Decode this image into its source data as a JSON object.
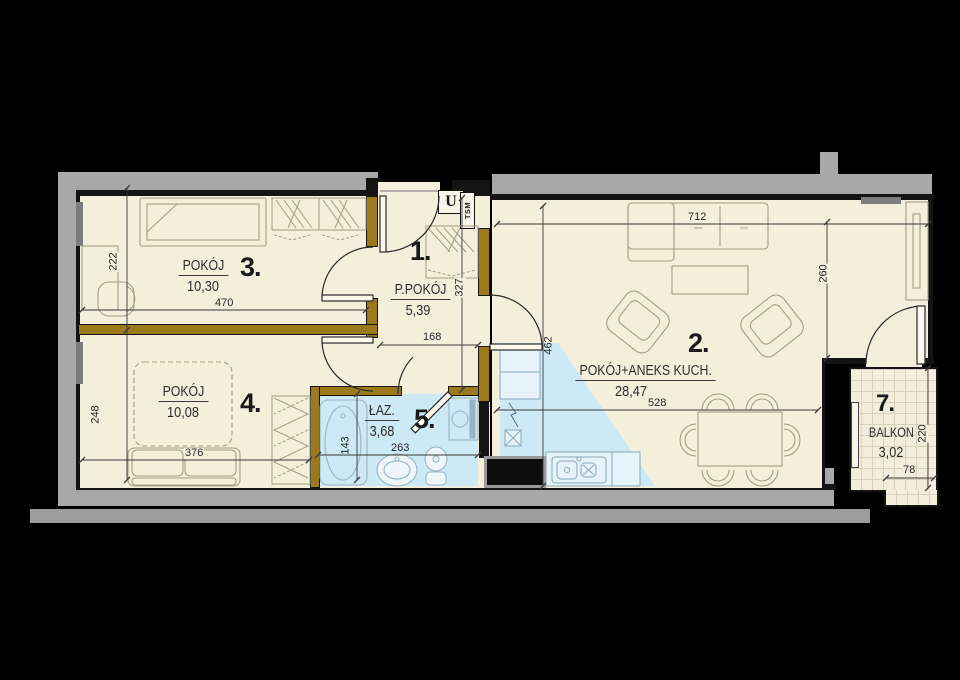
{
  "rooms": [
    {
      "id": "hall",
      "number": "1.",
      "name": "P.POKÓJ",
      "area": "5,39"
    },
    {
      "id": "living",
      "number": "2.",
      "name": "POKÓJ+ANEKS KUCH.",
      "area": "28,47"
    },
    {
      "id": "room3",
      "number": "3.",
      "name": "POKÓJ",
      "area": "10,30"
    },
    {
      "id": "room4",
      "number": "4.",
      "name": "POKÓJ",
      "area": "10,08"
    },
    {
      "id": "bath",
      "number": "5.",
      "name": "ŁAZ.",
      "area": "3,68"
    },
    {
      "id": "balcony",
      "number": "7.",
      "name": "BALKON",
      "area": "3,02"
    }
  ],
  "dims": {
    "d222": "222",
    "d470": "470",
    "d248": "248",
    "d376": "376",
    "d143": "143",
    "d263": "263",
    "d327": "327",
    "d168": "168",
    "d462": "462",
    "d528": "528",
    "d712": "712",
    "d260": "260",
    "d220": "220",
    "d78": "78"
  },
  "labels": {
    "u": "U",
    "tsm": "TSM"
  },
  "colors": {
    "floor": "#f4efdb",
    "wet_floor": "#cde9f6",
    "wood_wall": "#9c7a1c",
    "exterior_wall": "#a8a8a8",
    "outline": "#141414"
  }
}
